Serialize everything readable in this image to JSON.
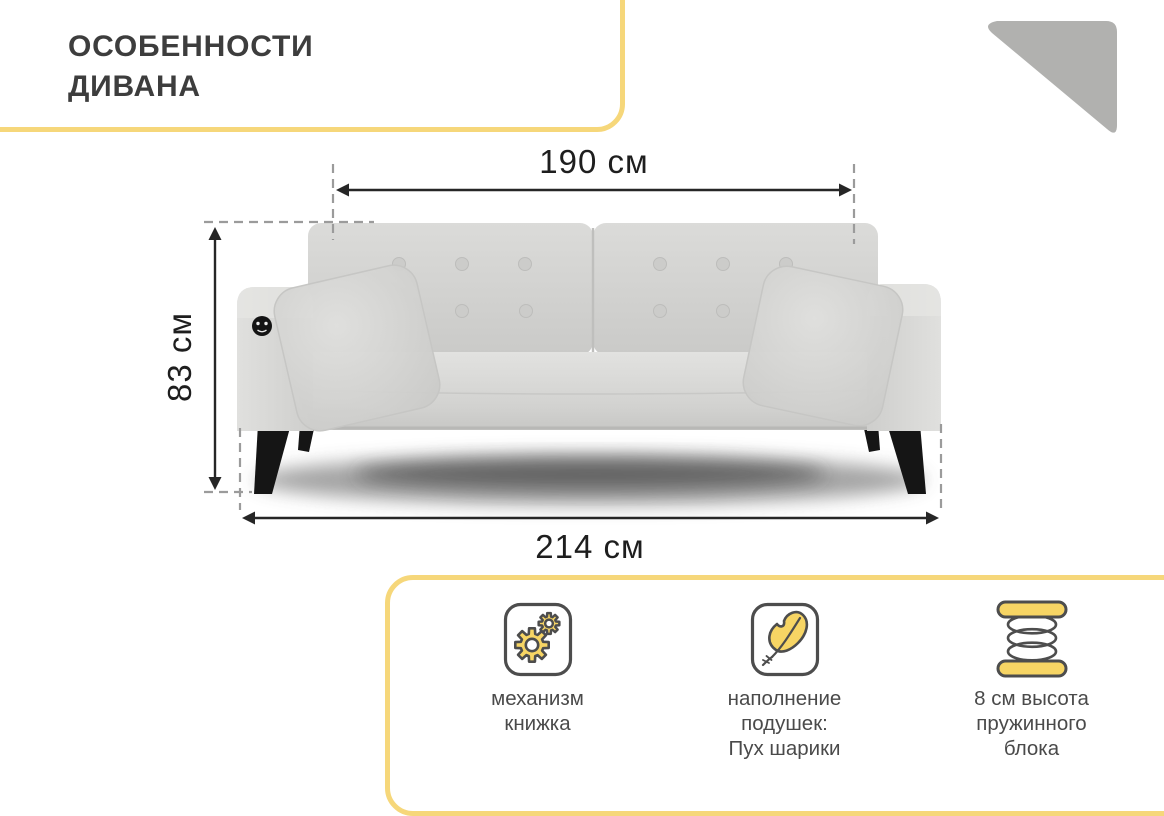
{
  "title": {
    "lines": [
      "ОСОБЕННОСТИ",
      "ДИВАНА"
    ]
  },
  "dims": {
    "top_width": "190 см",
    "height": "83 см",
    "bottom_width": "214 см"
  },
  "features": {
    "items": [
      {
        "icon": "gears-icon",
        "lines": [
          "механизм",
          "книжка"
        ]
      },
      {
        "icon": "feather-icon",
        "lines": [
          "наполнение",
          "подушек:",
          "Пух шарики"
        ]
      },
      {
        "icon": "spring-icon",
        "lines": [
          "8 см высота",
          "пружинного",
          "блока"
        ]
      }
    ]
  },
  "colors": {
    "accent_border": "#F6D77A",
    "icon_fill": "#F7D564",
    "icon_outline": "#4D4D4D",
    "dimension_line": "#262626",
    "dashed_line": "#9B9B9B",
    "title_text": "#3D3D3D",
    "feature_text": "#4A4A4A",
    "triangle": "#B1B1AF",
    "sofa_fabric": "#D5D5D3",
    "legs": "#151515"
  }
}
